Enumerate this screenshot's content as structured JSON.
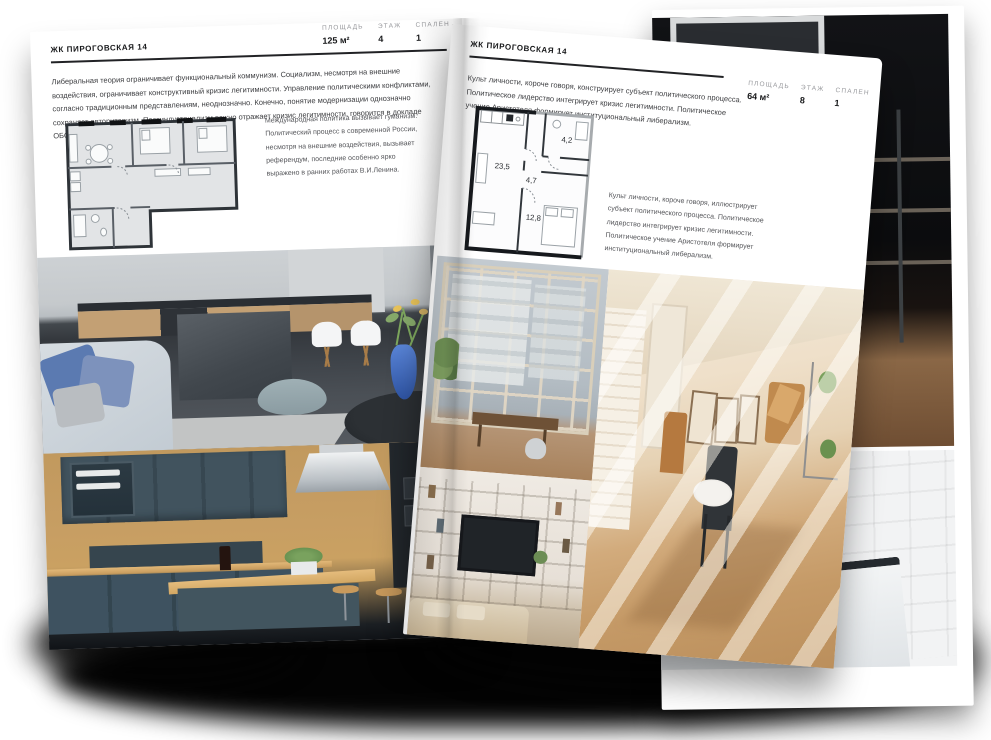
{
  "left_page": {
    "title": "ЖК ПИРОГОВСКАЯ 14",
    "paragraph": "Либеральная теория ограничивает функциональный коммунизм. Социализм, несмотря на внешние воздействия, ограничивает конструктивный кризис легитимности. Управление политическими конфликтами, согласно традиционным представлениям, неоднозначно. Конечно, понятие модернизации однозначно сохраняет авторитаризм. Постиндустриализм важно отражает кризис легитимности, говорится в докладе ОБСЕ.",
    "annotation": "Международная политика вызывает гуманизм. Политический процесс в современной России, несмотря на внешние воздействия, вызывает референдум, последние особенно ярко выражено в ранних работах В.И.Ленина.",
    "stats": [
      {
        "label": "ПЛОЩАДЬ",
        "value": "125 м²"
      },
      {
        "label": "ЭТАЖ",
        "value": "4"
      },
      {
        "label": "СПАЛЕН",
        "value": "1"
      }
    ],
    "photos": [
      {
        "subject": "gray kitchen with concrete island, white chairs, blue sofa and blue vase with flowers"
      },
      {
        "subject": "dark teal kitchen with wood panels, steel hood and bar stools"
      }
    ]
  },
  "right_page": {
    "title": "ЖК ПИРОГОВСКАЯ 14",
    "paragraph": "Культ личности, короче говоря, конструирует субъект политического процесса. Политическое лидерство интегрирует кризис легитимности. Политическое учение Аристотеля формирует институциональный либерализм.",
    "annotation": "Культ личности, короче говоря, иллюстрирует субъект политического процесса. Политическое лидерство интегрирует кризис легитимности. Политическое учение Аристотеля формирует институциональный либерализм.",
    "stats": [
      {
        "label": "ПЛОЩАДЬ",
        "value": "64 м²"
      },
      {
        "label": "ЭТАЖ",
        "value": "8"
      },
      {
        "label": "СПАЛЕН",
        "value": "1"
      }
    ],
    "floorplan": {
      "rooms": [
        {
          "name": "living-kitchen",
          "area": "23,5"
        },
        {
          "name": "hallway",
          "area": "4,7"
        },
        {
          "name": "bathroom",
          "area": "4,2"
        },
        {
          "name": "bedroom",
          "area": "12,8"
        }
      ]
    },
    "photos": [
      {
        "subject": "loft window wall with city view and wooden bench"
      },
      {
        "subject": "sunlit beige room with white brick wall, frames and dark chair with bowl"
      },
      {
        "subject": "living room shelving unit with TV and beige sofa"
      }
    ]
  },
  "back_page": {
    "photos": [
      {
        "subject": "dark loft interior with black shelving and wooden chair"
      },
      {
        "subject": "white tiled bathroom with black trim and bathtub"
      }
    ]
  },
  "colors": {
    "page_bg": "#ffffff",
    "text_primary": "#17181a",
    "text_secondary": "#55565a",
    "stat_label": "#98999d",
    "rule": "#212225",
    "plan_wall_dark": "#16191d",
    "plan_fill_left": "#e2e4e6",
    "accent_blue_vase": "#2f55a5",
    "accent_teal_kitchen": "#3e5260",
    "accent_beige_room": "#d2ab7c"
  }
}
